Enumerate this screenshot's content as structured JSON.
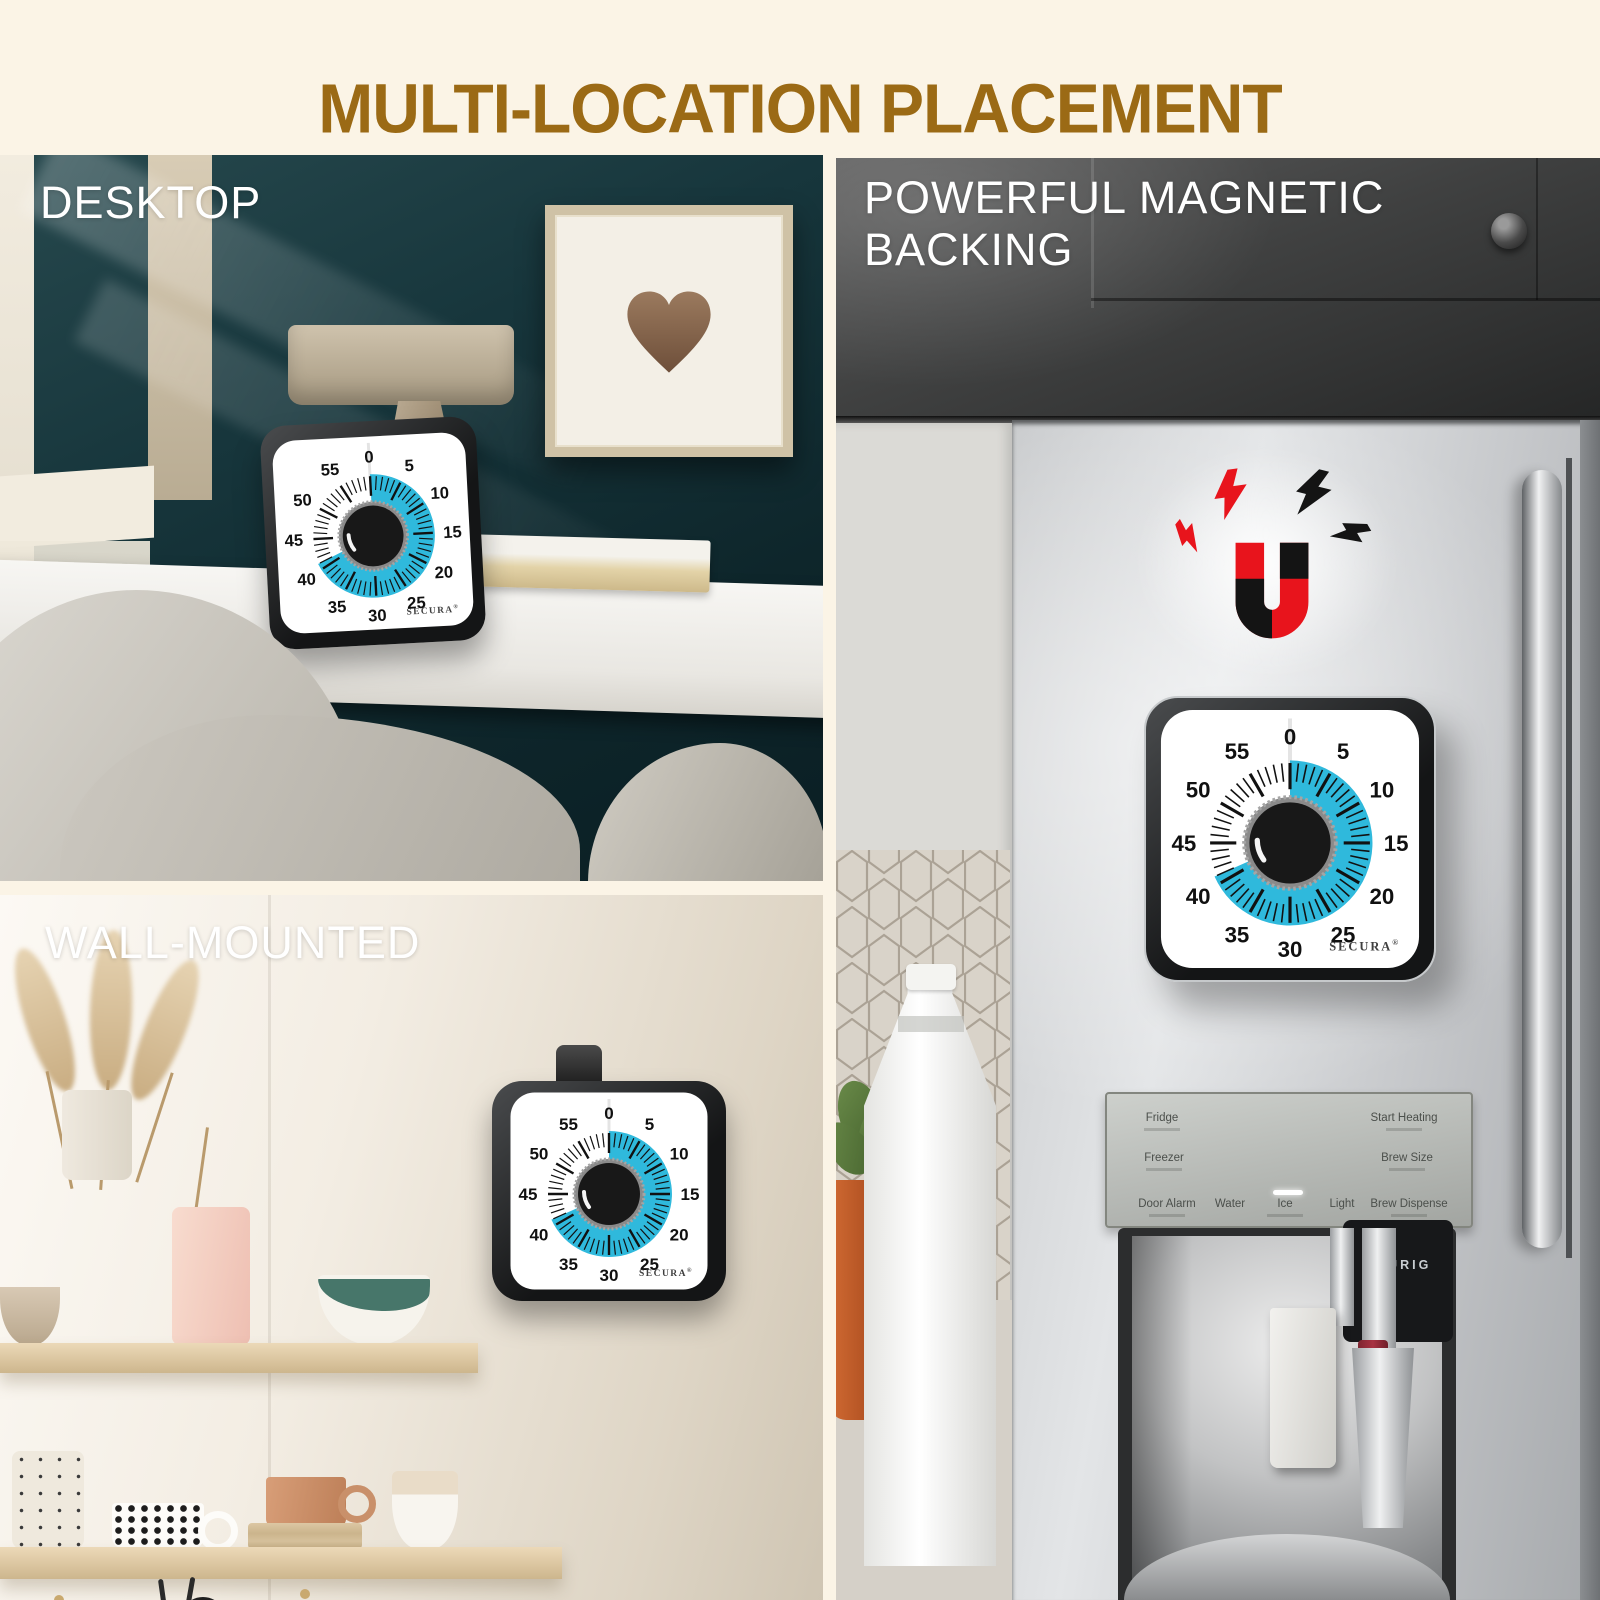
{
  "page": {
    "title": "MULTI-LOCATION PLACEMENT",
    "title_color": "#9b6a15",
    "background_color": "#fbf4e6"
  },
  "panels": {
    "desktop": {
      "label": "DESKTOP"
    },
    "wall_mounted": {
      "label": "WALL-MOUNTED"
    },
    "magnetic": {
      "label": "POWERFUL MAGNETIC BACKING"
    }
  },
  "timer": {
    "brand": "SECURA",
    "registered_mark": "®",
    "dial_numbers": [
      0,
      5,
      10,
      15,
      20,
      25,
      30,
      35,
      40,
      45,
      50,
      55
    ],
    "minutes_total": 60,
    "set_minutes": 41,
    "colors": {
      "sector": "#2fb9dc",
      "face": "#ffffff",
      "frame": "#1d1d1f",
      "knob": "#181818",
      "tick": "#111111"
    }
  },
  "magnet_icon": {
    "colors": {
      "red": "#e8141c",
      "black": "#141414"
    }
  },
  "fridge_dispenser": {
    "labels_row1": [
      "Fridge",
      "Start Heating"
    ],
    "labels_row2": [
      "Freezer",
      "Brew Size"
    ],
    "labels_bottom": [
      "Door Alarm",
      "Water",
      "Ice",
      "Light",
      "Brew Dispense"
    ],
    "keurig_label": "KEURIG"
  }
}
